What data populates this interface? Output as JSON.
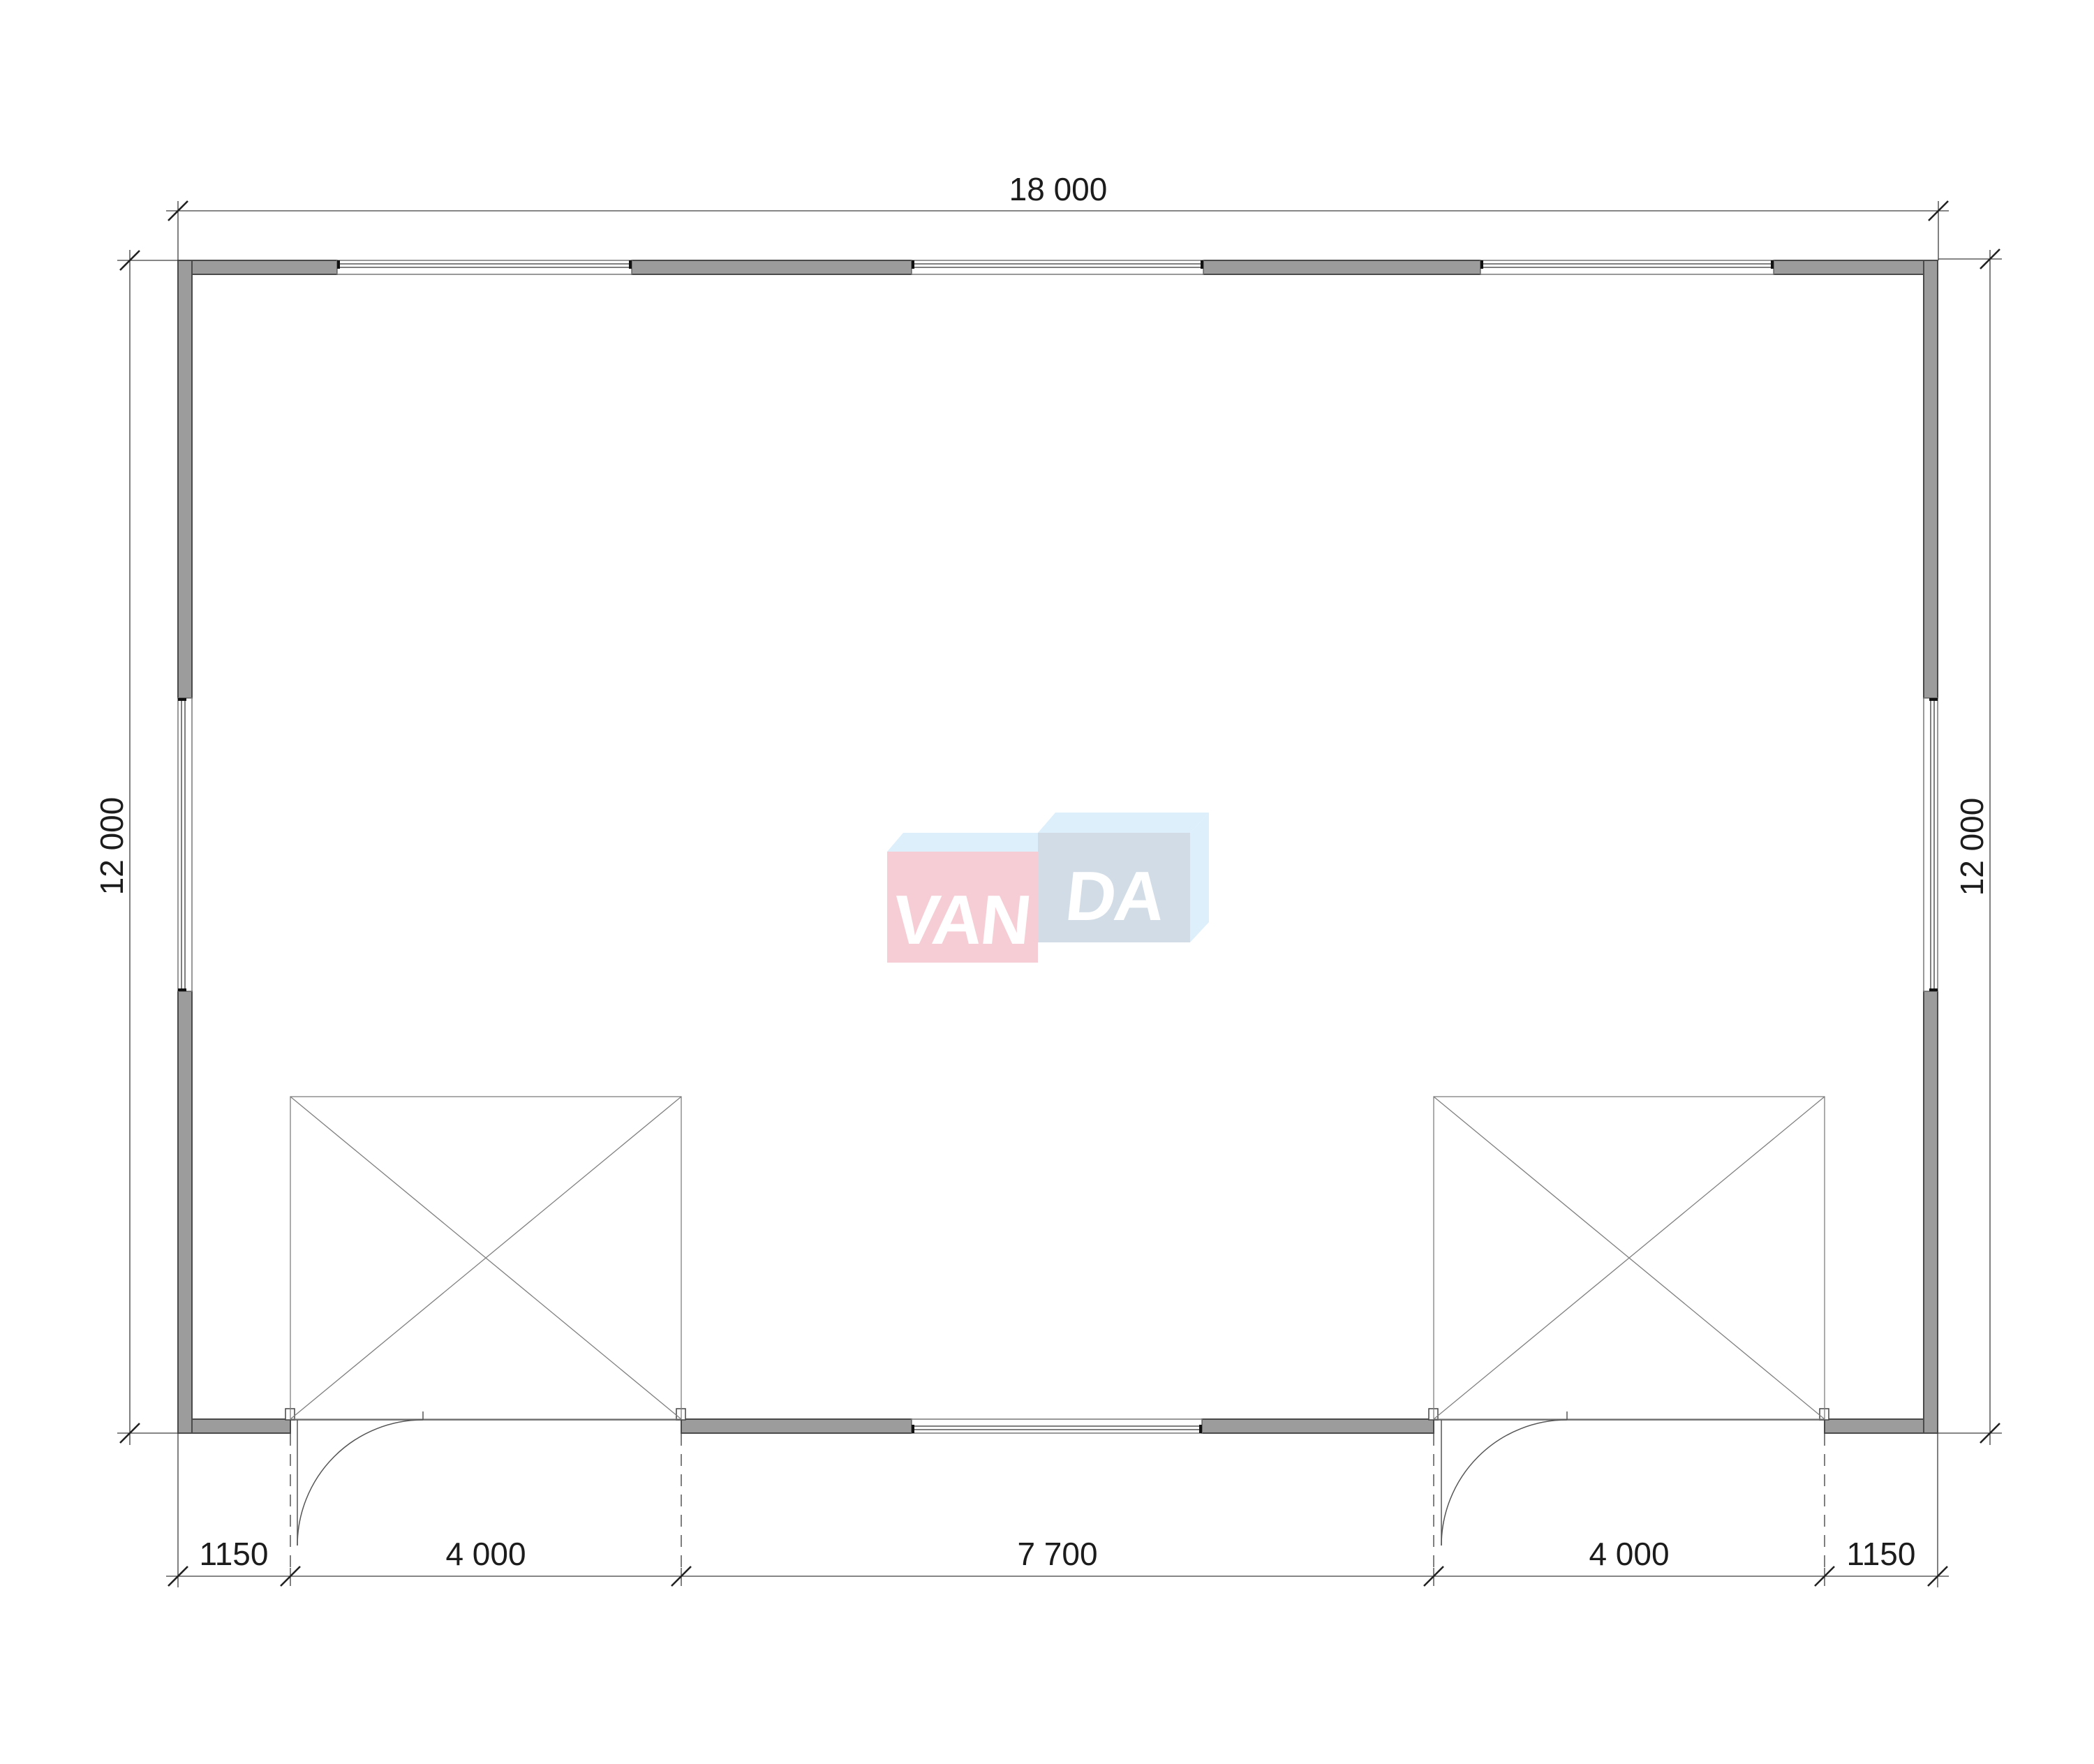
{
  "drawing": {
    "type_label": "floor-plan",
    "dimensions": {
      "top_overall": "18 000",
      "left_overall": "12 000",
      "right_overall": "12 000",
      "bottom_chain": [
        "1150",
        "4 000",
        "7 700",
        "4 000",
        "1150"
      ]
    },
    "watermark": {
      "brand": "VANDA",
      "left_letters": "VAN",
      "right_letters": "DA",
      "pink_box_color": "#f6c8d0",
      "blue_box_color": "#cdd9e5",
      "light_blue_face_color": "#daeefb",
      "letter_color": "#ffffff"
    },
    "colors": {
      "wall_fill": "#9c9c9c",
      "wall_outline": "#4a4a4a",
      "thin_line": "#555555",
      "dimension_line": "#3d3d3d",
      "text": "#1c1c1c",
      "background": "#ffffff"
    }
  }
}
